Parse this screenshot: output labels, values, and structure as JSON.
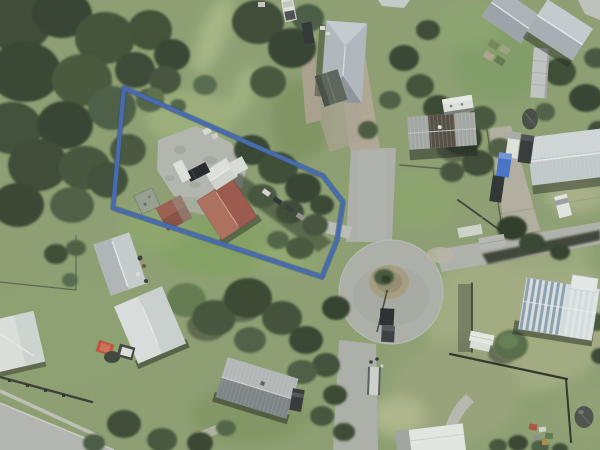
{
  "map": {
    "type": "aerial-imagery",
    "description": "Aerial satellite photograph of a residential cul-de-sac neighbourhood with one parcel outlined in blue",
    "visible_text": [],
    "boundary": {
      "points": "124,88 323,176 343,202 337,240 322,277 113,208",
      "color": "#3a62b0",
      "halo_color": "#26406f",
      "stroke_width": 4.2
    },
    "palette": {
      "grass": "#8b9f6e",
      "dry_grass": "#a2ac7e",
      "asphalt": "#aeb1ac",
      "gravel": "#b2a895",
      "concrete_pad": "#b5b8b1",
      "tree_dark": "#2e3b28",
      "subject_roof_red": "#9b5044",
      "neighbor_roof_white": "#e1e5e4",
      "neighbor_roof_bluegray": "#b2bbc3",
      "striped_roof_blue": "#8ba0b1"
    },
    "features": [
      {
        "name": "property-boundary"
      },
      {
        "name": "subject-red-roof-house"
      },
      {
        "name": "subject-garage"
      },
      {
        "name": "subject-concrete-yard"
      },
      {
        "name": "cul-de-sac"
      },
      {
        "name": "street-north"
      },
      {
        "name": "street-east"
      },
      {
        "name": "street-south"
      },
      {
        "name": "street-bottom-left"
      },
      {
        "name": "blue-gray-hip-roof-house"
      },
      {
        "name": "gray-corrugated-house"
      },
      {
        "name": "striped-metal-roof-house"
      },
      {
        "name": "light-gray-shed-right"
      },
      {
        "name": "white-hip-roof-house"
      },
      {
        "name": "white-shed"
      },
      {
        "name": "left-edge-white-roof-house"
      },
      {
        "name": "gray-roof-house-bottom"
      },
      {
        "name": "white-building-bottom"
      },
      {
        "name": "caravan"
      },
      {
        "name": "parked-vehicles"
      },
      {
        "name": "water-tank"
      },
      {
        "name": "turning-island"
      },
      {
        "name": "tree-cover"
      }
    ]
  }
}
